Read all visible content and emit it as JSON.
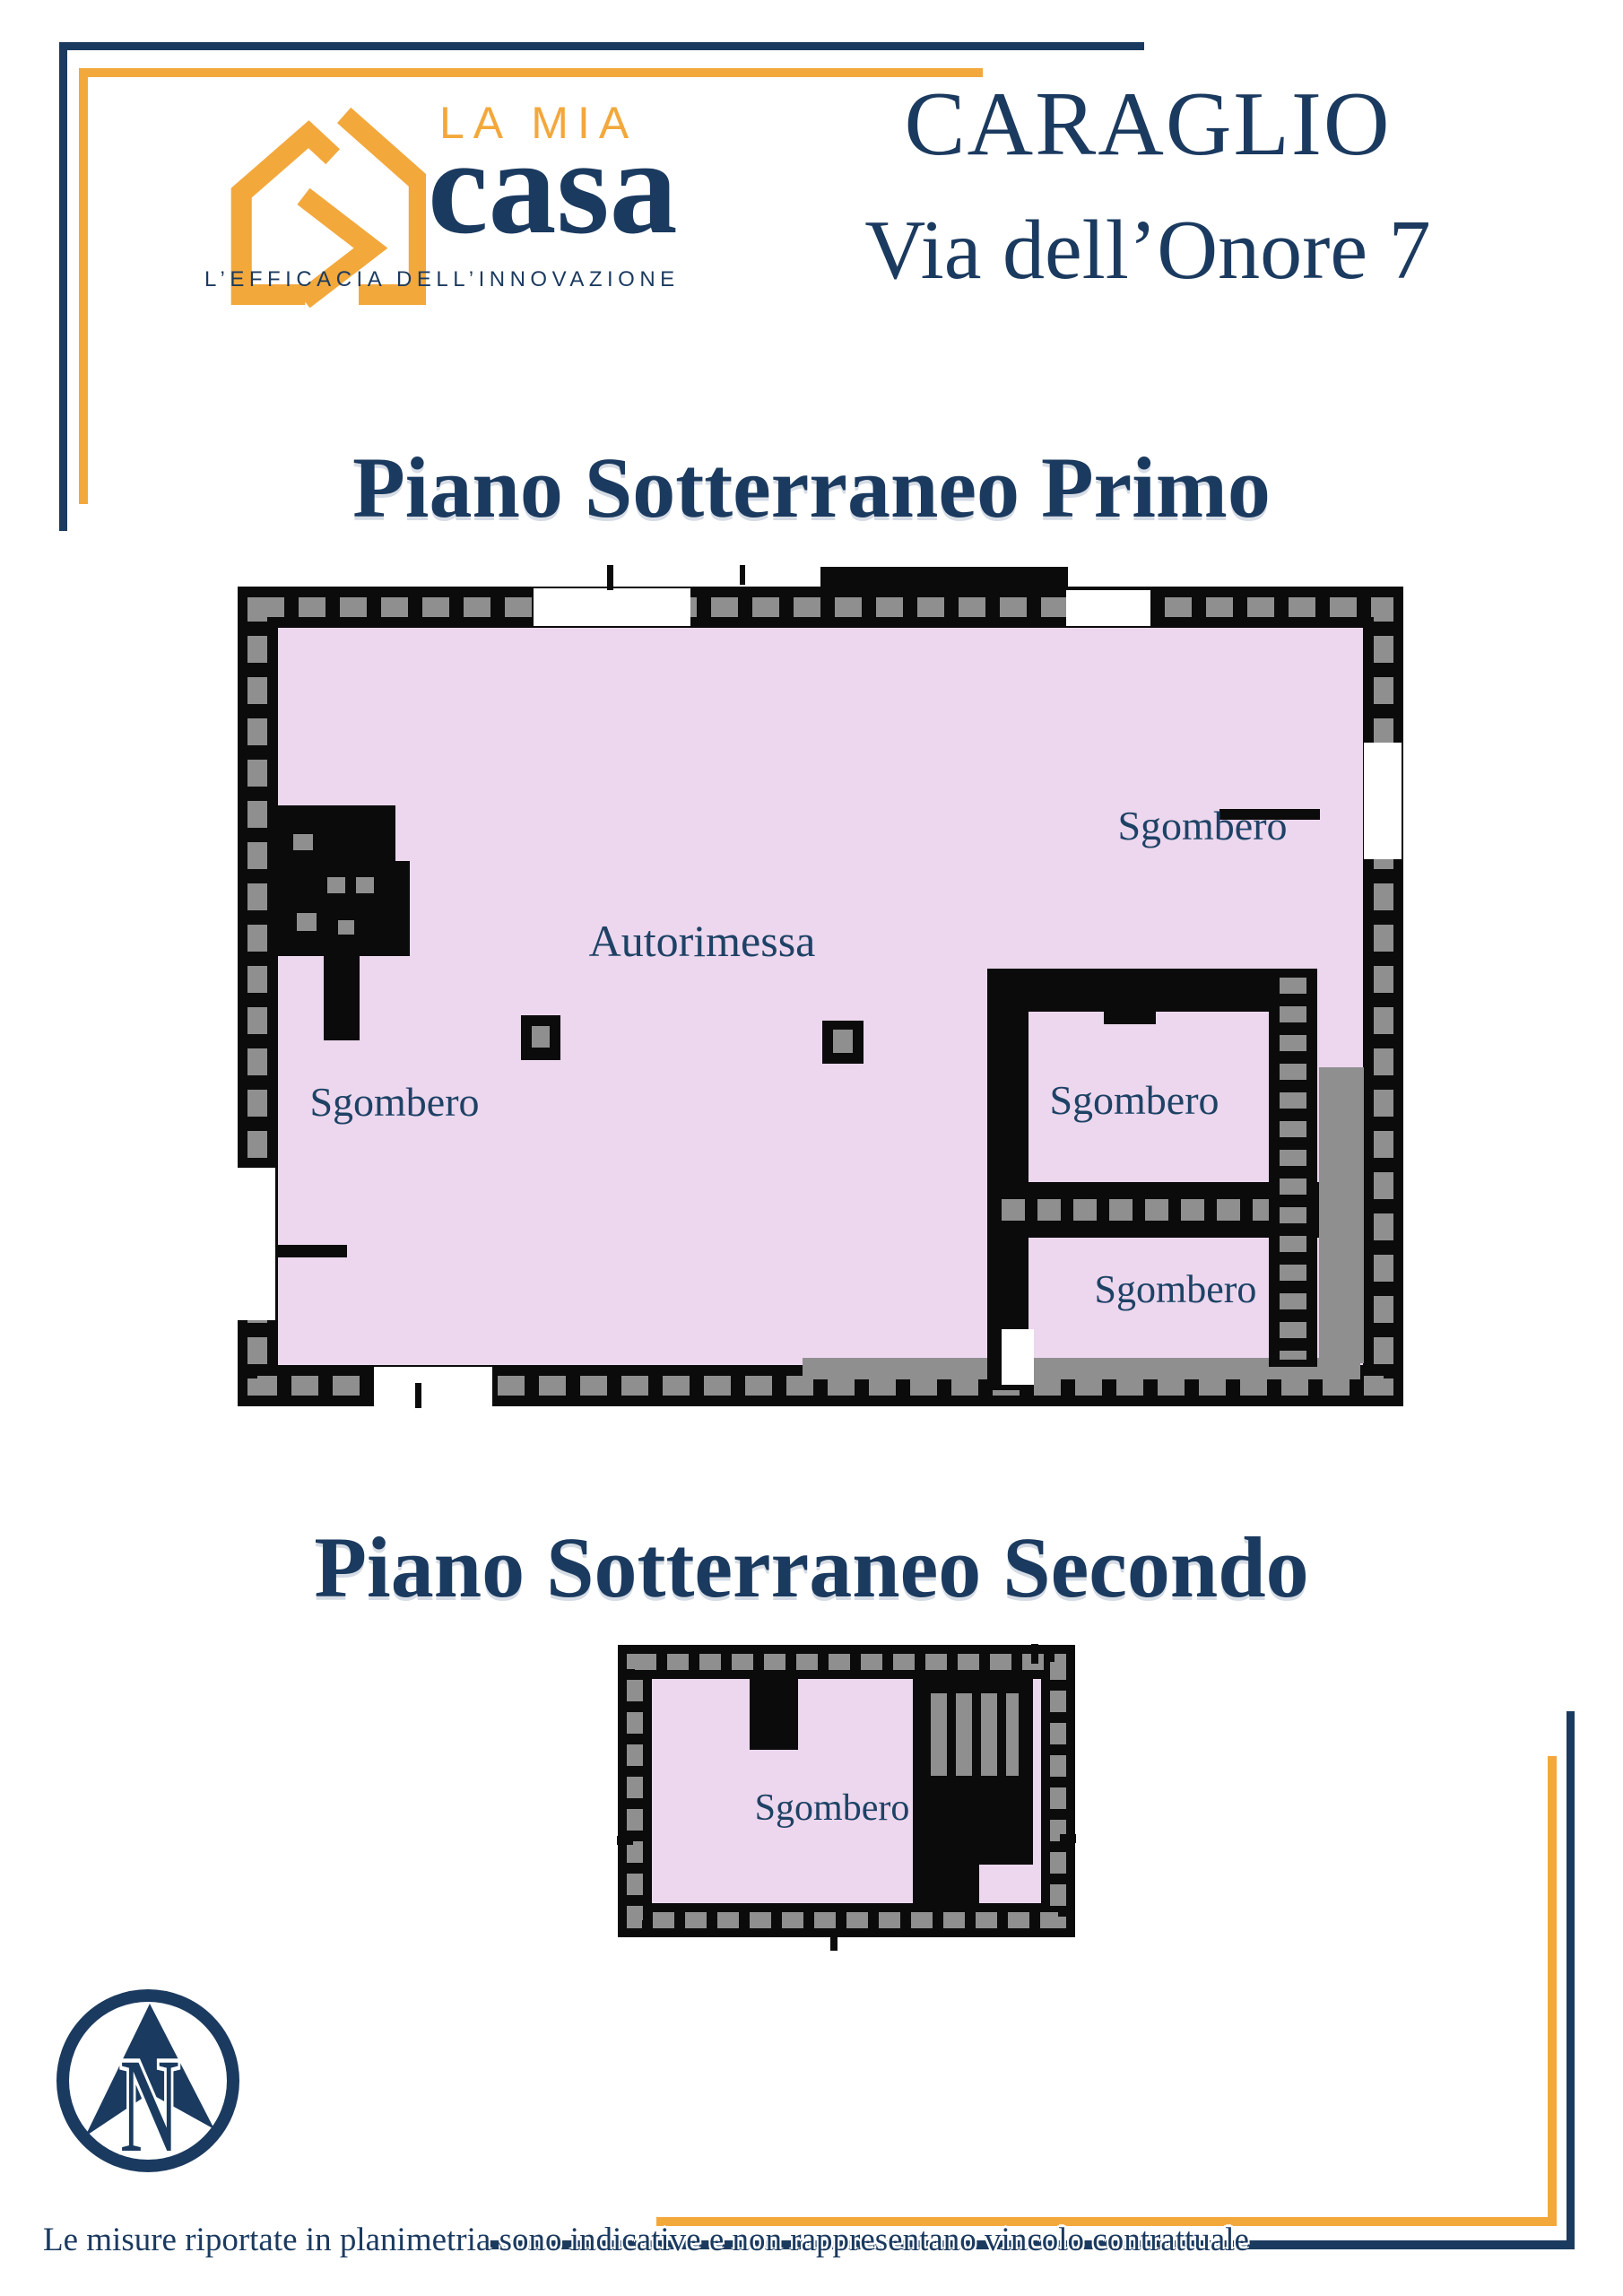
{
  "brand": {
    "name_top": "LA MIA",
    "name_main": "casa",
    "tagline": "L’EFFICACIA DELL’INNOVAZIONE"
  },
  "header": {
    "city": "CARAGLIO",
    "address": "Via dell’Onore 7"
  },
  "floor1": {
    "title": "Piano Sotterraneo Primo",
    "rooms": [
      {
        "label": "Autorimessa"
      },
      {
        "label": "Sgombero"
      },
      {
        "label": "Sgombero"
      },
      {
        "label": "Sgombero"
      },
      {
        "label": "Sgombero"
      }
    ]
  },
  "floor2": {
    "title": "Piano Sotterraneo Secondo",
    "rooms": [
      {
        "label": "Sgombero"
      }
    ]
  },
  "compass": {
    "north_letter": "N"
  },
  "footer": {
    "disclaimer": "Le misure riportate in planimetria sono indicative e non rappresentano vincolo contrattuale"
  },
  "colors": {
    "navy": "#1b3a5f",
    "orange": "#f3a83c",
    "room_fill": "#ecd7ee",
    "wall_black": "#0b0b0b",
    "hatch_gray": "#8f8f8f"
  }
}
